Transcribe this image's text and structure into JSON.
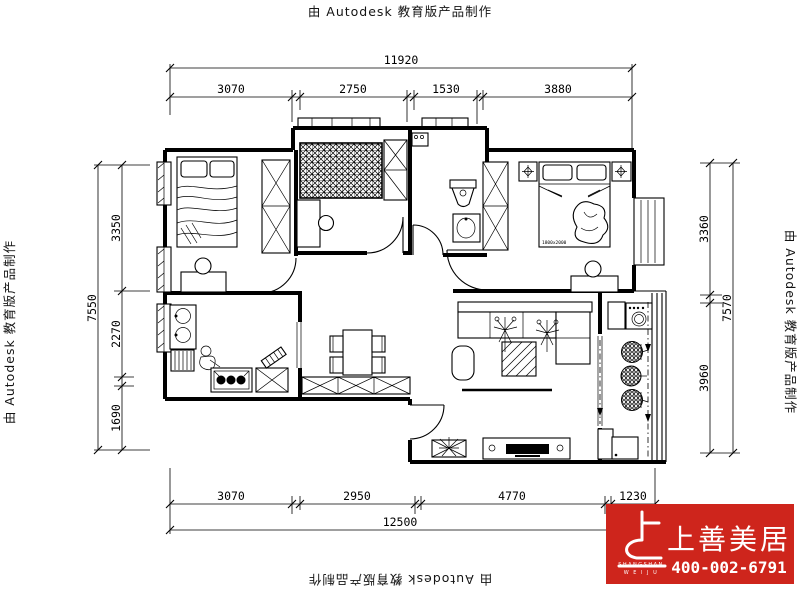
{
  "watermarks": {
    "text": "由 Autodesk 教育版产品制作"
  },
  "dimensions": {
    "top": {
      "total": "11920",
      "seg1": "3070",
      "seg2": "2750",
      "seg3": "1530",
      "seg4": "3880"
    },
    "bottom": {
      "total": "12500",
      "seg1": "3070",
      "seg2": "2950",
      "seg3": "4770",
      "seg4": "1230"
    },
    "left": {
      "total": "7550",
      "seg1": "3350",
      "seg2": "2270",
      "seg3": "1690"
    },
    "right": {
      "total": "7570",
      "seg1": "3360",
      "seg2": "3960"
    }
  },
  "labels": {
    "bed_size": "1800x2000"
  },
  "logo": {
    "name": "上善美居",
    "latin1": "SHANGSHAN",
    "latin2": "W E I J U",
    "phone": "400-002-6791",
    "bg_color": "#ce251c"
  }
}
